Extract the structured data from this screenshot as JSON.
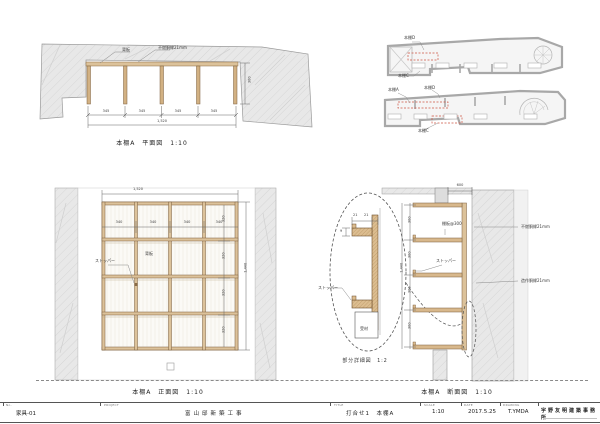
{
  "plan": {
    "caption": "本棚A　平面図　1:10",
    "label_back_board": "背板",
    "label_panel": "不燃胴縁21mm",
    "dim_bay": "345",
    "dim_overall": "1,520",
    "dim_depth": "300"
  },
  "key_plans": {
    "upper": {
      "label_d": "本棚D",
      "label_c": "本棚C"
    },
    "lower": {
      "label_a": "本棚A",
      "label_d": "本棚D",
      "label_c": "本棚C"
    }
  },
  "elevation": {
    "caption": "本棚A　正面図　1:10",
    "label_stopper": "ストッパー",
    "label_back_board": "背板",
    "dim_overall_w": "1,520",
    "dim_overall_h": "1,440",
    "dim_bay": "340",
    "dim_row": "320",
    "dim_t": "21"
  },
  "detail": {
    "caption": "部分詳細図　1:2",
    "label_stopper": "ストッパー",
    "label_support": "受材",
    "dim_t1": "21",
    "dim_t2": "21",
    "dim_gap": "9"
  },
  "section": {
    "caption": "本棚A　断面図　1:10",
    "label_shelf_pitch": "棚板@300",
    "label_stopper": "ストッパー",
    "label_finish_top": "不燃胴縁21mm",
    "label_finish_bottom": "造作胴縁21mm",
    "dim_pitch": "300",
    "dim_overall": "1,440",
    "dim_top": "600",
    "dim_t": "21"
  },
  "title_block": {
    "no_label": "No.",
    "no_value": "家具-01",
    "project_label": "PROJECT",
    "project_value": "富山邸新築工事",
    "title_label": "TITLE",
    "title_value": "打合せ1　本棚A",
    "scale_label": "SCALE",
    "scale_value": "1:10",
    "date_label": "DATE",
    "date_value": "2017.5.25",
    "drawing_label": "DRAWING",
    "drawing_value": "T.YMDA",
    "firm_name": "宇野友明建築事務所"
  }
}
